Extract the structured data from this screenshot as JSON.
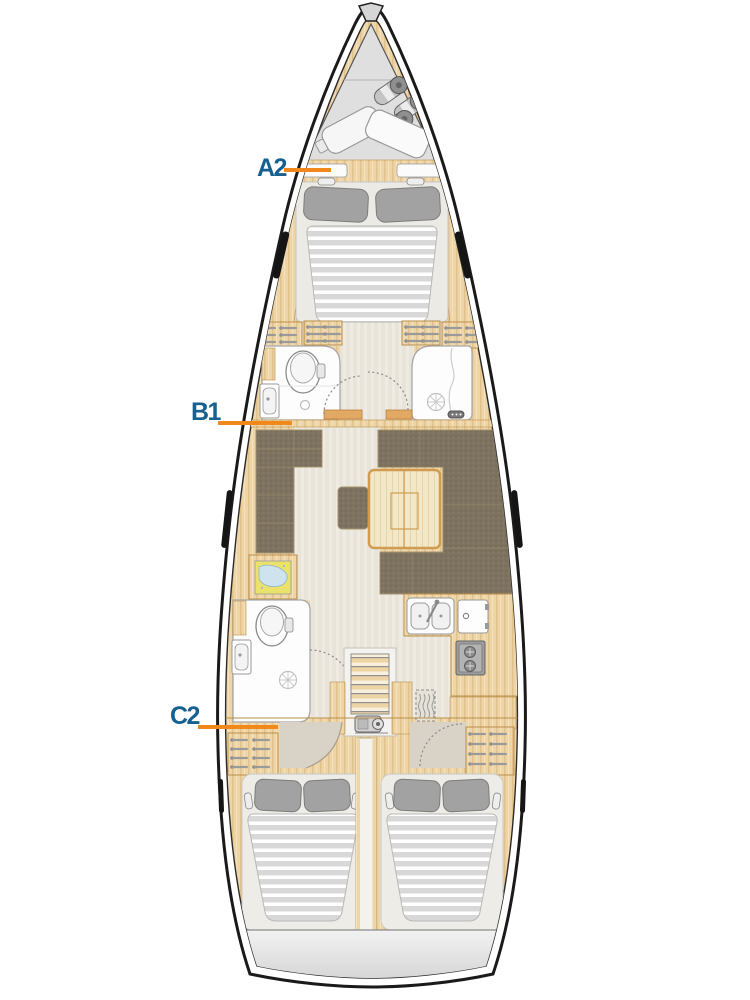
{
  "labels": [
    {
      "id": "A2",
      "text": "A2"
    },
    {
      "id": "B1",
      "text": "B1"
    },
    {
      "id": "C2",
      "text": "C2"
    }
  ],
  "colors": {
    "label_text": "#16618f",
    "pointer_line": "#f0881c",
    "hull_fill": "#ffffff",
    "hull_outline": "#1a1a1a",
    "wood": "#eed5a7",
    "wood_border": "#b98e4a",
    "floor": "#e9e4da",
    "upholstery": "#7e7261",
    "table_wood": "#f2e7c6",
    "table_border": "#cf9c52",
    "mattress": "#d8d8d8",
    "pillow": "#a2a2a2",
    "fixture_white": "#fdfdfd",
    "anchor_locker_gray": "#dfdfdf",
    "transom_gray": "#e0e0e0",
    "chart_map_yellow": "#eae26b",
    "entry_floor_taupe": "#d9d2c7"
  }
}
